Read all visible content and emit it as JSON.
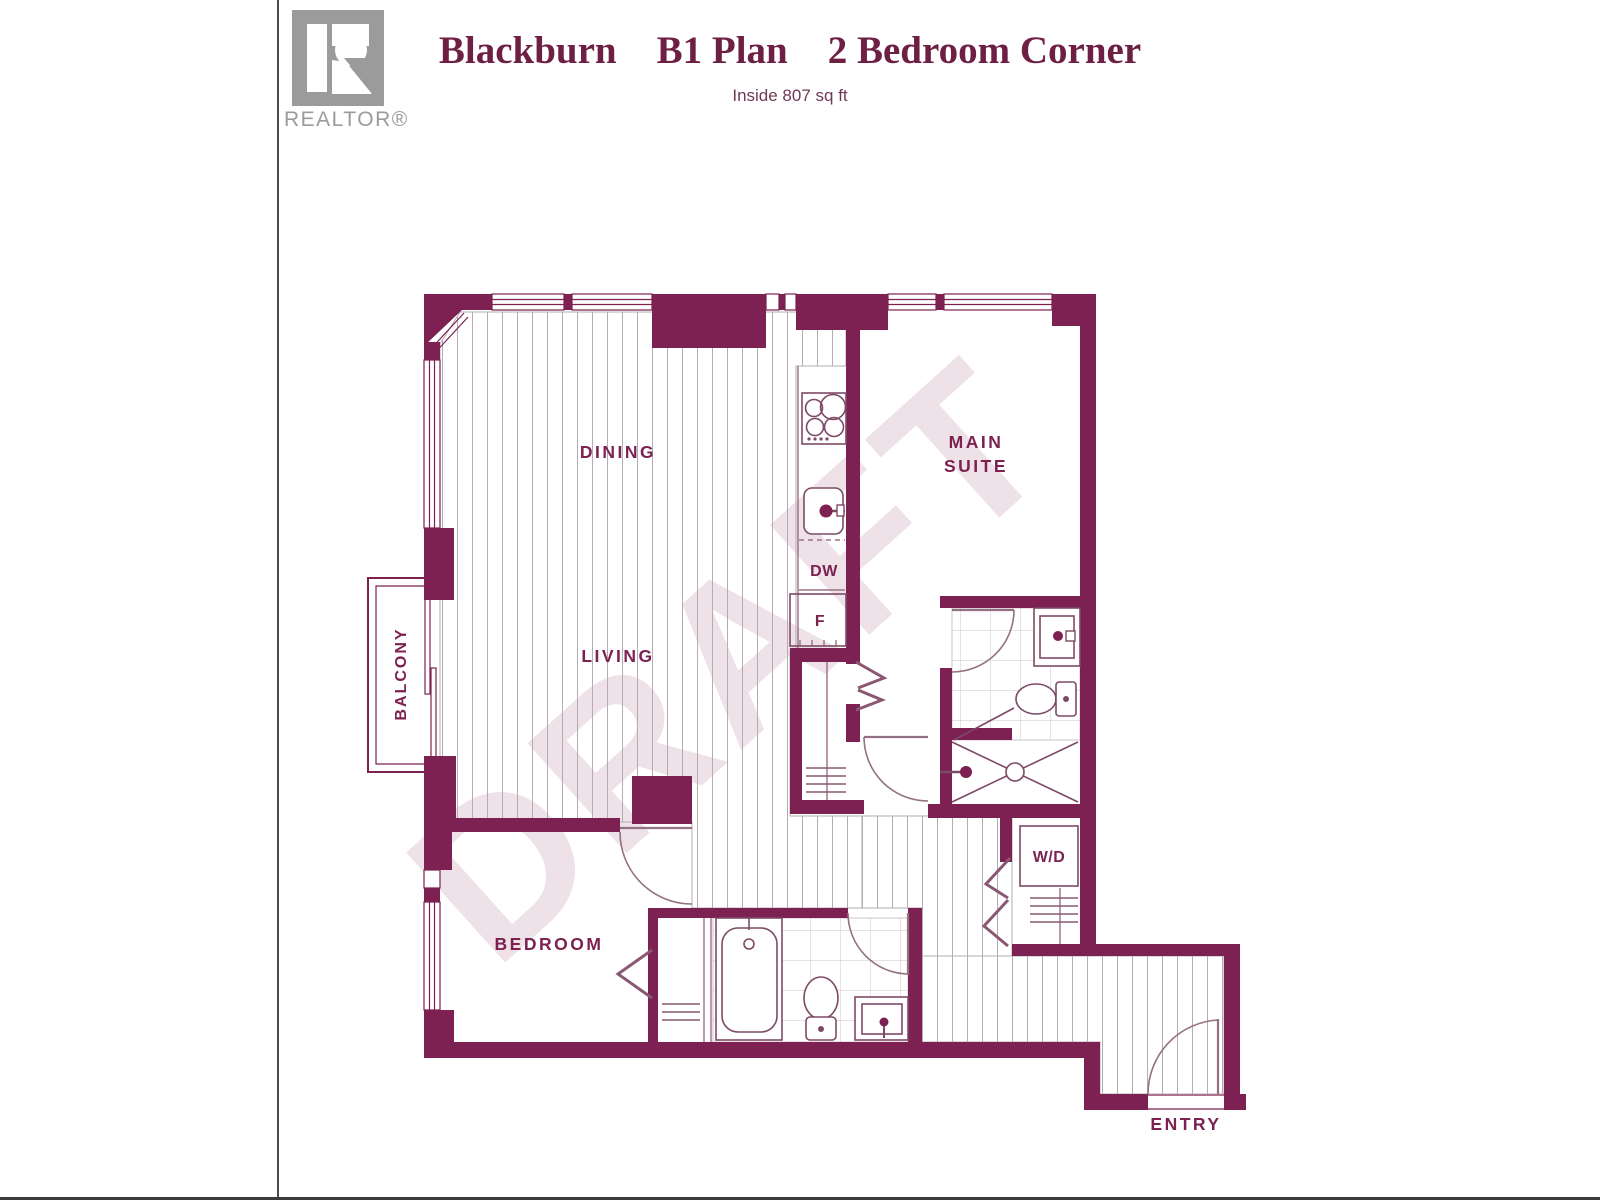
{
  "header": {
    "title_part1": "Blackburn",
    "title_part2": "B1 Plan",
    "title_part3": "2 Bedroom Corner",
    "subtitle": "Inside 807 sq ft"
  },
  "logo": {
    "letter": "R",
    "wordmark": "REALTOR®"
  },
  "watermark": {
    "text": "DRAFT"
  },
  "rooms": {
    "dining": "DINING",
    "living": "LIVING",
    "balcony": "BALCONY",
    "main_suite_line1": "MAIN",
    "main_suite_line2": "SUITE",
    "bedroom": "BEDROOM",
    "entry": "ENTRY"
  },
  "appliances": {
    "dishwasher": "DW",
    "fridge": "F",
    "washer_dryer": "W/D"
  },
  "colors": {
    "wall": "#7c2151",
    "title_text": "#6e1f44",
    "label_text": "#7c2151",
    "logo_gray": "#9b9b9b",
    "watermark": "#7c2151",
    "hatch_line": "#b4acb2",
    "tile_line": "#ccc3c9"
  }
}
